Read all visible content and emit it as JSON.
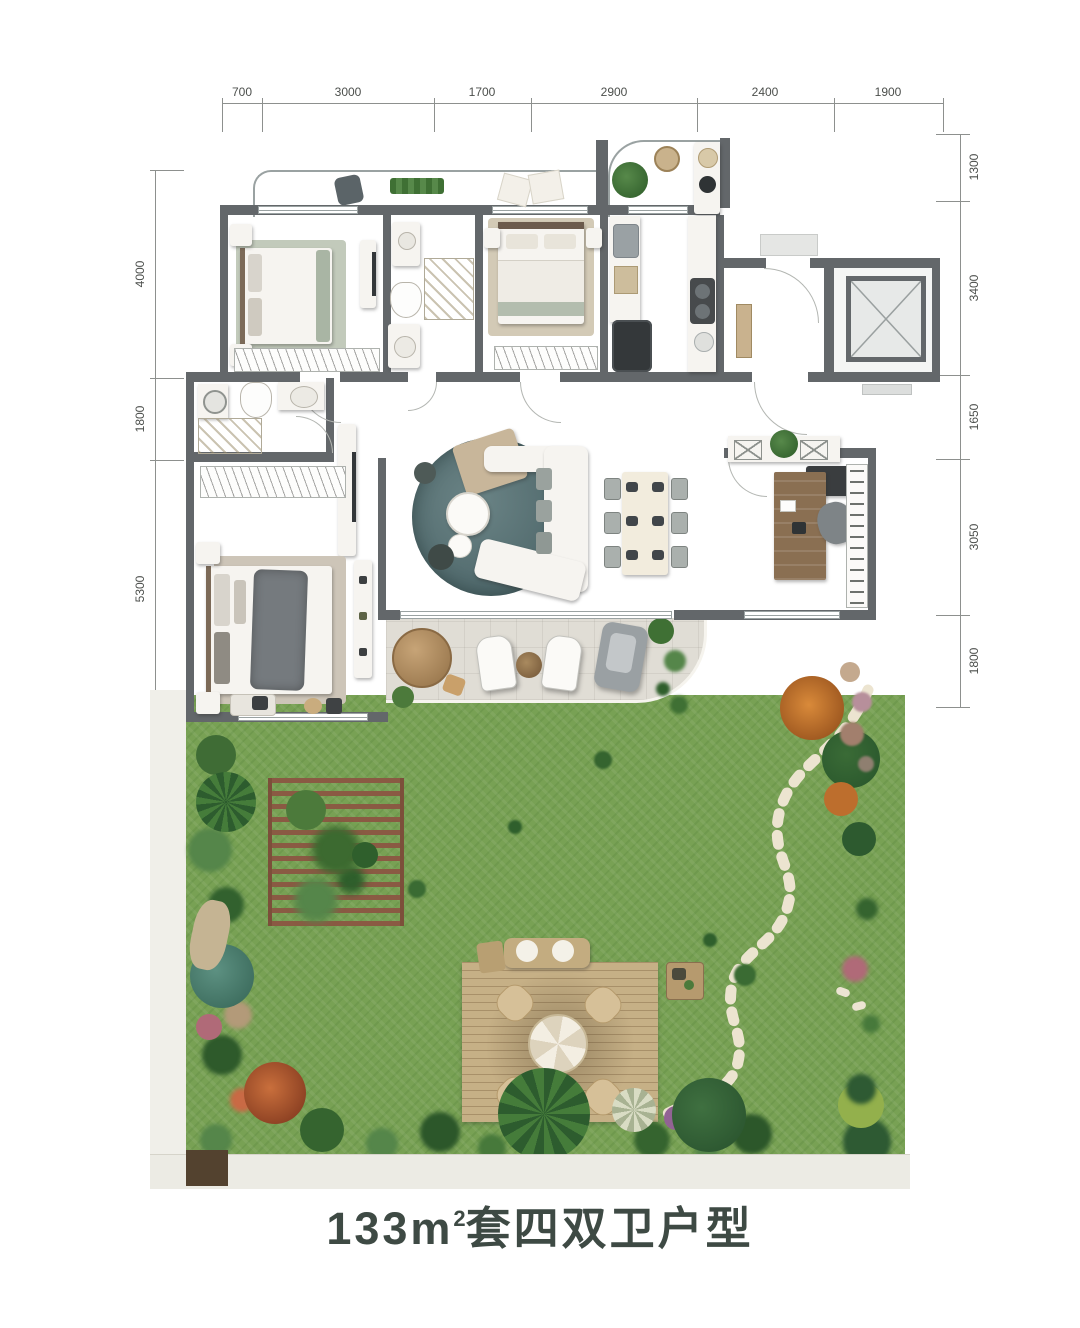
{
  "title": {
    "area": "133m",
    "sup": "2",
    "name": "套四双卫户型"
  },
  "dimensions": {
    "top": [
      "700",
      "3000",
      "1700",
      "2900",
      "2400",
      "1900"
    ],
    "left": [
      "4000",
      "1800",
      "5300"
    ],
    "right": [
      "1300",
      "3400",
      "1650",
      "3050",
      "1800"
    ]
  },
  "colors": {
    "wall": "#63676a",
    "wood_floor": "#94806f",
    "living_tile": "#d6d7d4",
    "lawn": "#78a154",
    "rug_teal": "#587375",
    "deck": "#c6b086",
    "brick": "#d9bd93",
    "title_text": "#3e4a44"
  }
}
